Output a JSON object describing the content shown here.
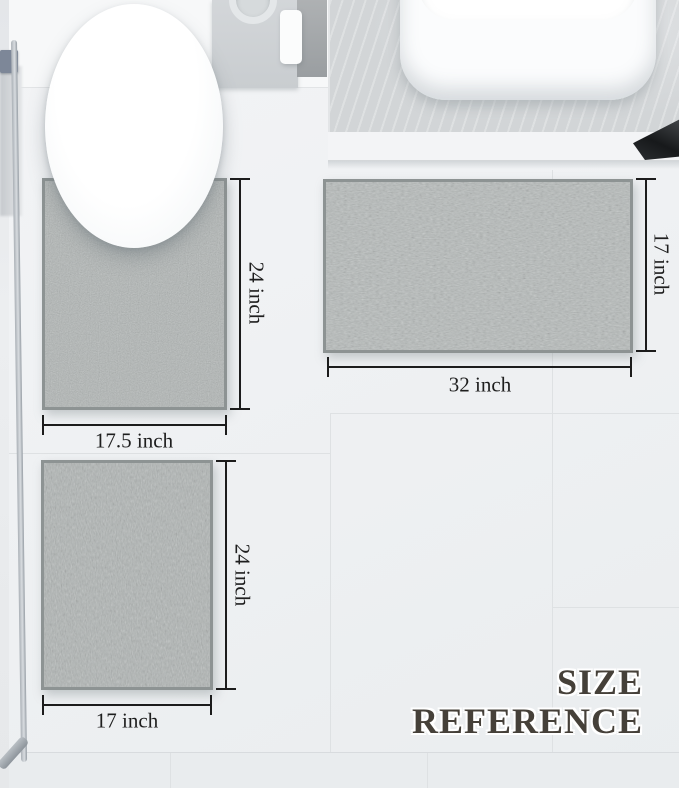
{
  "title": {
    "line1": "SIZE",
    "line2": "REFERENCE",
    "color": "#454039"
  },
  "mats": {
    "contour": {
      "width_label": "17.5 inch",
      "height_label": "24 inch"
    },
    "large": {
      "width_label": "32 inch",
      "height_label": "17 inch"
    },
    "small": {
      "width_label": "17 inch",
      "height_label": "24 inch"
    }
  },
  "colors": {
    "rug": "#b1b6b5",
    "rug_edge": "#8d9393",
    "dimension_line": "#1c1c1c",
    "floor": "#eef0f2",
    "counter": "#d2d5d7"
  }
}
